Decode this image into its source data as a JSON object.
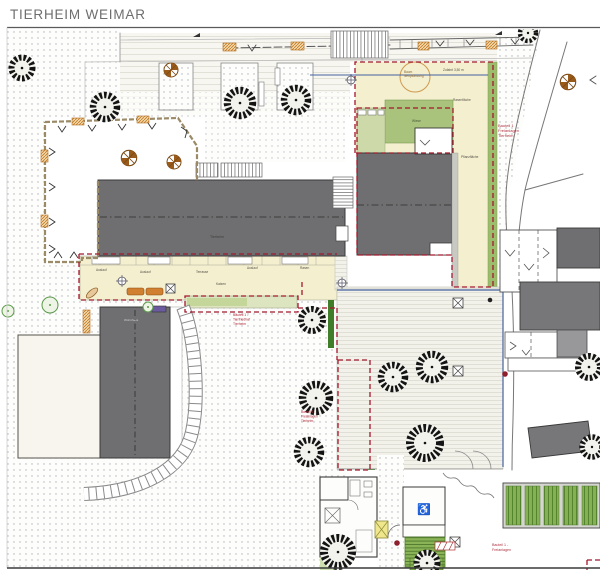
{
  "header": {
    "title": "TIERHEIM WEIMAR"
  },
  "plan": {
    "main_building_label": "Tierheim",
    "house_label": "Wohnhaus",
    "annotations": [
      {
        "id": "bauteil-1-freianlagen-tierheim-ost",
        "lines": [
          "Bauteil 1",
          "Freianlagen",
          "Tierheim"
        ]
      },
      {
        "id": "bauteil-1-tierfriedhof",
        "lines": [
          "Bauteil 1 -",
          "Tierfriedhof",
          "Tierheim"
        ]
      },
      {
        "id": "bauteil-2-freianlagen",
        "lines": [
          "Bauteil 2 -",
          "Freianlagen",
          "Tierheim"
        ]
      },
      {
        "id": "bauteil-1-freianlagen-sued",
        "lines": [
          "Bauteil 1 -",
          "Freianlagen"
        ]
      }
    ],
    "micro_labels": [
      "Baum",
      "Neupflanzung",
      "Zufahrt 3,50 m",
      "Rasenfläche",
      "Pflanzfläche",
      "Wiese",
      "Auslauf",
      "Auslauf",
      "Terrasse",
      "Auslauf",
      "Rasen",
      "Katzen"
    ],
    "symbols": {
      "felled_tree_marker": "felled-tree-icon",
      "new_tree_marker": "new-tree-icon",
      "drain_shaft": "drain-shaft-icon",
      "survey_point": "survey-point-icon",
      "accessible_room": "wheelchair-icon"
    },
    "colors": {
      "boundary_red": "#a3192d",
      "roof_dark": "#6f6f71",
      "lawn_green": "#a9c27c",
      "hedge_green": "#3f7d28",
      "accent_orange": "#c07a28",
      "utility_blue": "#44619f",
      "area_yellow": "#f4efcf",
      "title_gray": "#6e6e6e"
    }
  }
}
